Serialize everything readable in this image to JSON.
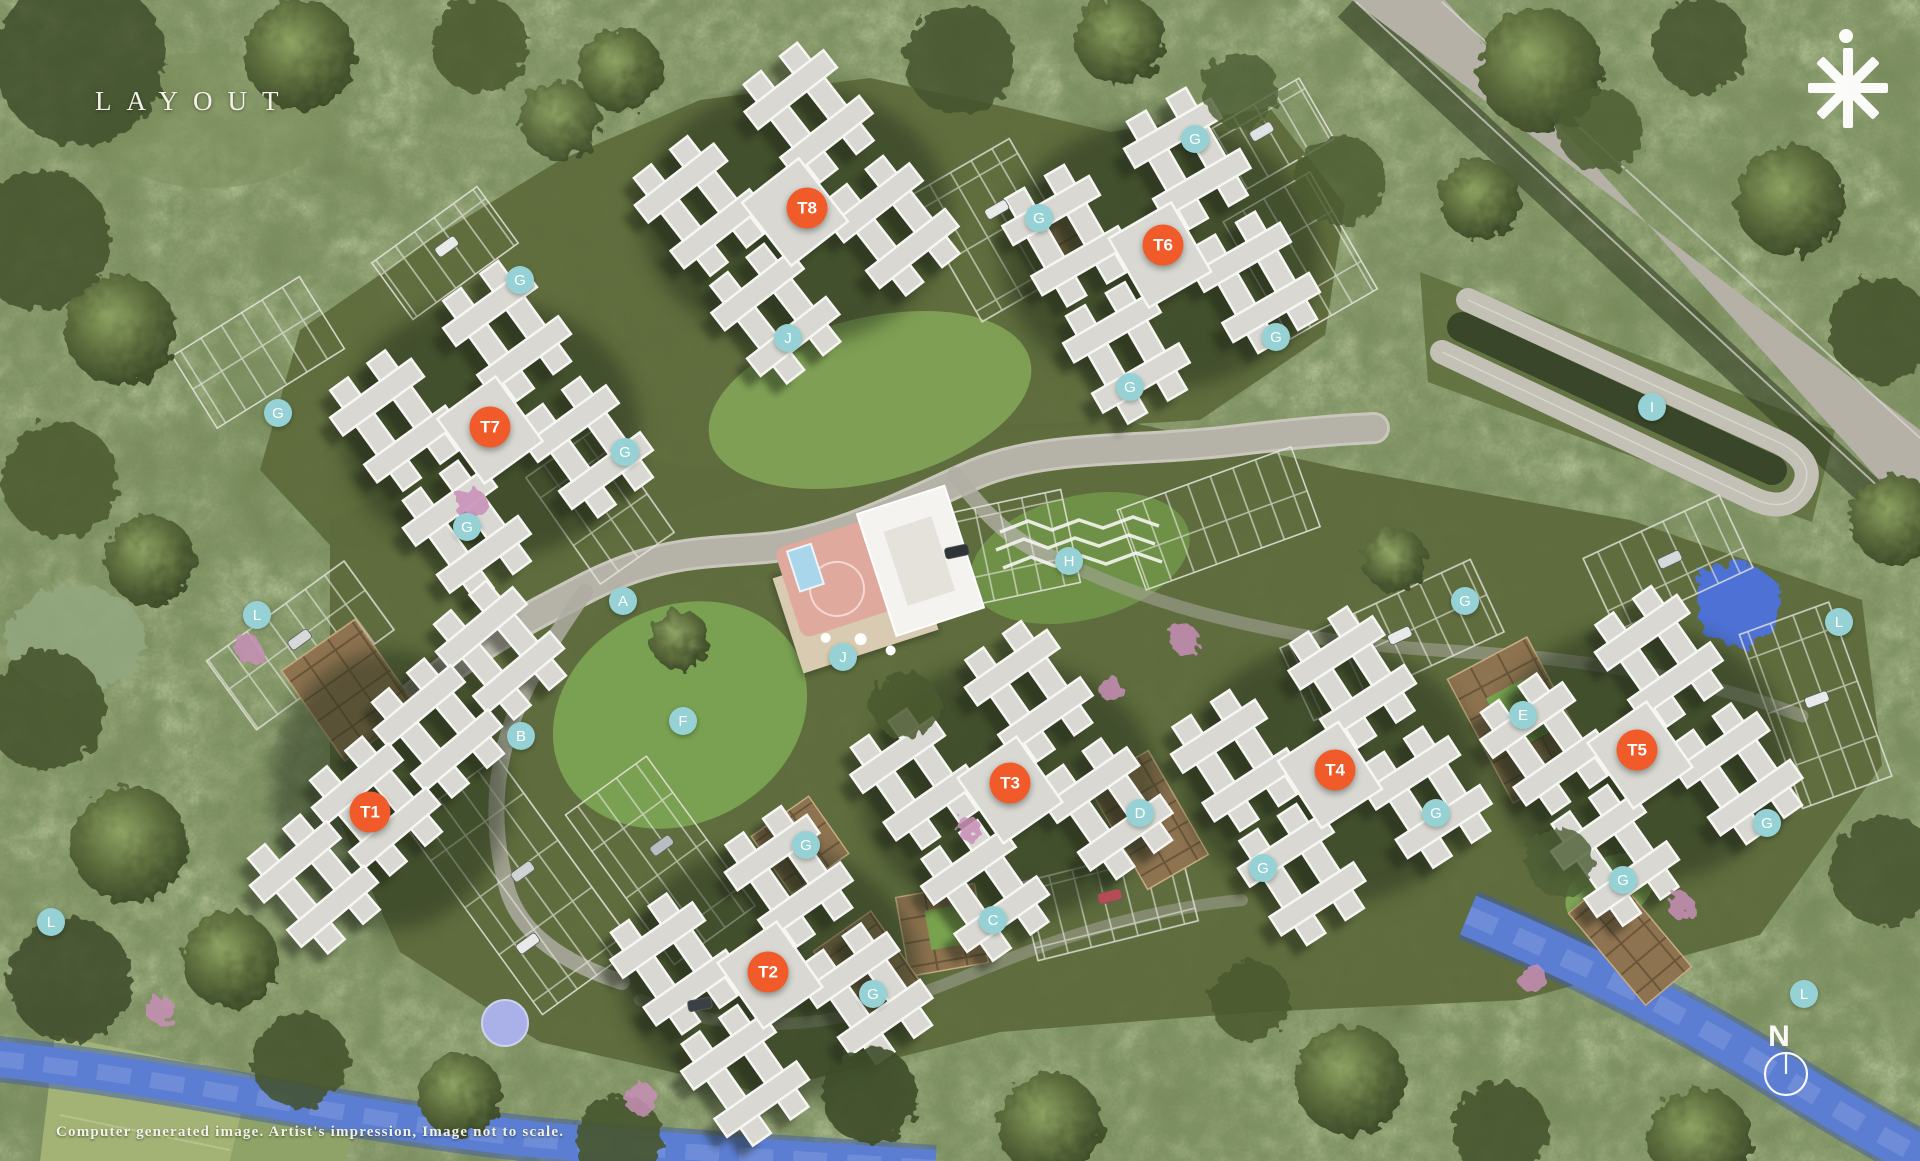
{
  "title": "LAYOUT",
  "disclaimer": "Computer generated image. Artist's impression, Image not to scale.",
  "compass": {
    "north_label": "N"
  },
  "colors": {
    "tower_marker": "#F15A29",
    "amenity_marker": "#96D2D5",
    "marker_text": "#FFFFFF",
    "river": "#5B7ED2",
    "forest": "#68774A"
  },
  "towers": [
    {
      "id": "T1",
      "x": 370,
      "y": 812
    },
    {
      "id": "T2",
      "x": 768,
      "y": 972
    },
    {
      "id": "T3",
      "x": 1010,
      "y": 783
    },
    {
      "id": "T4",
      "x": 1335,
      "y": 770
    },
    {
      "id": "T5",
      "x": 1637,
      "y": 750
    },
    {
      "id": "T6",
      "x": 1163,
      "y": 245
    },
    {
      "id": "T7",
      "x": 490,
      "y": 427
    },
    {
      "id": "T8",
      "x": 807,
      "y": 208
    }
  ],
  "amenity_markers": [
    {
      "label": "A",
      "x": 623,
      "y": 601
    },
    {
      "label": "B",
      "x": 521,
      "y": 736
    },
    {
      "label": "C",
      "x": 993,
      "y": 920
    },
    {
      "label": "D",
      "x": 1140,
      "y": 813
    },
    {
      "label": "E",
      "x": 1523,
      "y": 715
    },
    {
      "label": "F",
      "x": 683,
      "y": 721
    },
    {
      "label": "H",
      "x": 1069,
      "y": 561
    },
    {
      "label": "I",
      "x": 1652,
      "y": 407
    },
    {
      "label": "J",
      "x": 788,
      "y": 338
    },
    {
      "label": "J",
      "x": 843,
      "y": 657
    },
    {
      "label": "G",
      "x": 520,
      "y": 280
    },
    {
      "label": "G",
      "x": 1039,
      "y": 218
    },
    {
      "label": "G",
      "x": 1195,
      "y": 139
    },
    {
      "label": "G",
      "x": 1276,
      "y": 337
    },
    {
      "label": "G",
      "x": 1130,
      "y": 387
    },
    {
      "label": "G",
      "x": 278,
      "y": 413
    },
    {
      "label": "G",
      "x": 625,
      "y": 452
    },
    {
      "label": "G",
      "x": 467,
      "y": 527
    },
    {
      "label": "G",
      "x": 806,
      "y": 845
    },
    {
      "label": "G",
      "x": 873,
      "y": 994
    },
    {
      "label": "G",
      "x": 1263,
      "y": 868
    },
    {
      "label": "G",
      "x": 1436,
      "y": 813
    },
    {
      "label": "G",
      "x": 1465,
      "y": 601
    },
    {
      "label": "G",
      "x": 1623,
      "y": 880
    },
    {
      "label": "G",
      "x": 1767,
      "y": 823
    },
    {
      "label": "L",
      "x": 257,
      "y": 615
    },
    {
      "label": "L",
      "x": 51,
      "y": 922
    },
    {
      "label": "L",
      "x": 1839,
      "y": 622
    },
    {
      "label": "L",
      "x": 1804,
      "y": 994
    }
  ]
}
